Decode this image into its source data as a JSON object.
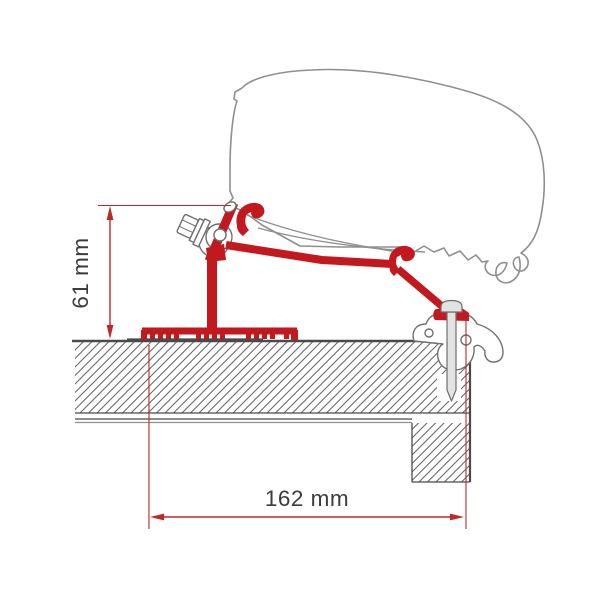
{
  "diagram": {
    "kind": "technical-cross-section",
    "subject": "awning-roof-adapter-bracket-mounted-on-caravan-roof",
    "dimensions": [
      {
        "id": "bracket-height",
        "label": "61 mm",
        "value": 61,
        "unit": "mm",
        "orientation": "vertical"
      },
      {
        "id": "mount-width",
        "label": "162 mm",
        "value": 162,
        "unit": "mm",
        "orientation": "horizontal"
      }
    ],
    "parts": [
      "awning-case-outline",
      "adapter-bracket",
      "mounting-bolt",
      "fixing-screw",
      "awning-rail-profile",
      "roof-cross-section",
      "wall-cross-section"
    ],
    "colors": {
      "background": "#ffffff",
      "bracket_red": "#c2181e",
      "dimension_red": "#c0272b",
      "outline_gray": "#8f8f8f",
      "roof_line_dark": "#4a4a4a",
      "hatch_gray": "#6a6a6a",
      "metal_gray": "#6f6f6f",
      "metal_fill": "#e3e3e3",
      "label_text": "#3c3c3c"
    }
  }
}
